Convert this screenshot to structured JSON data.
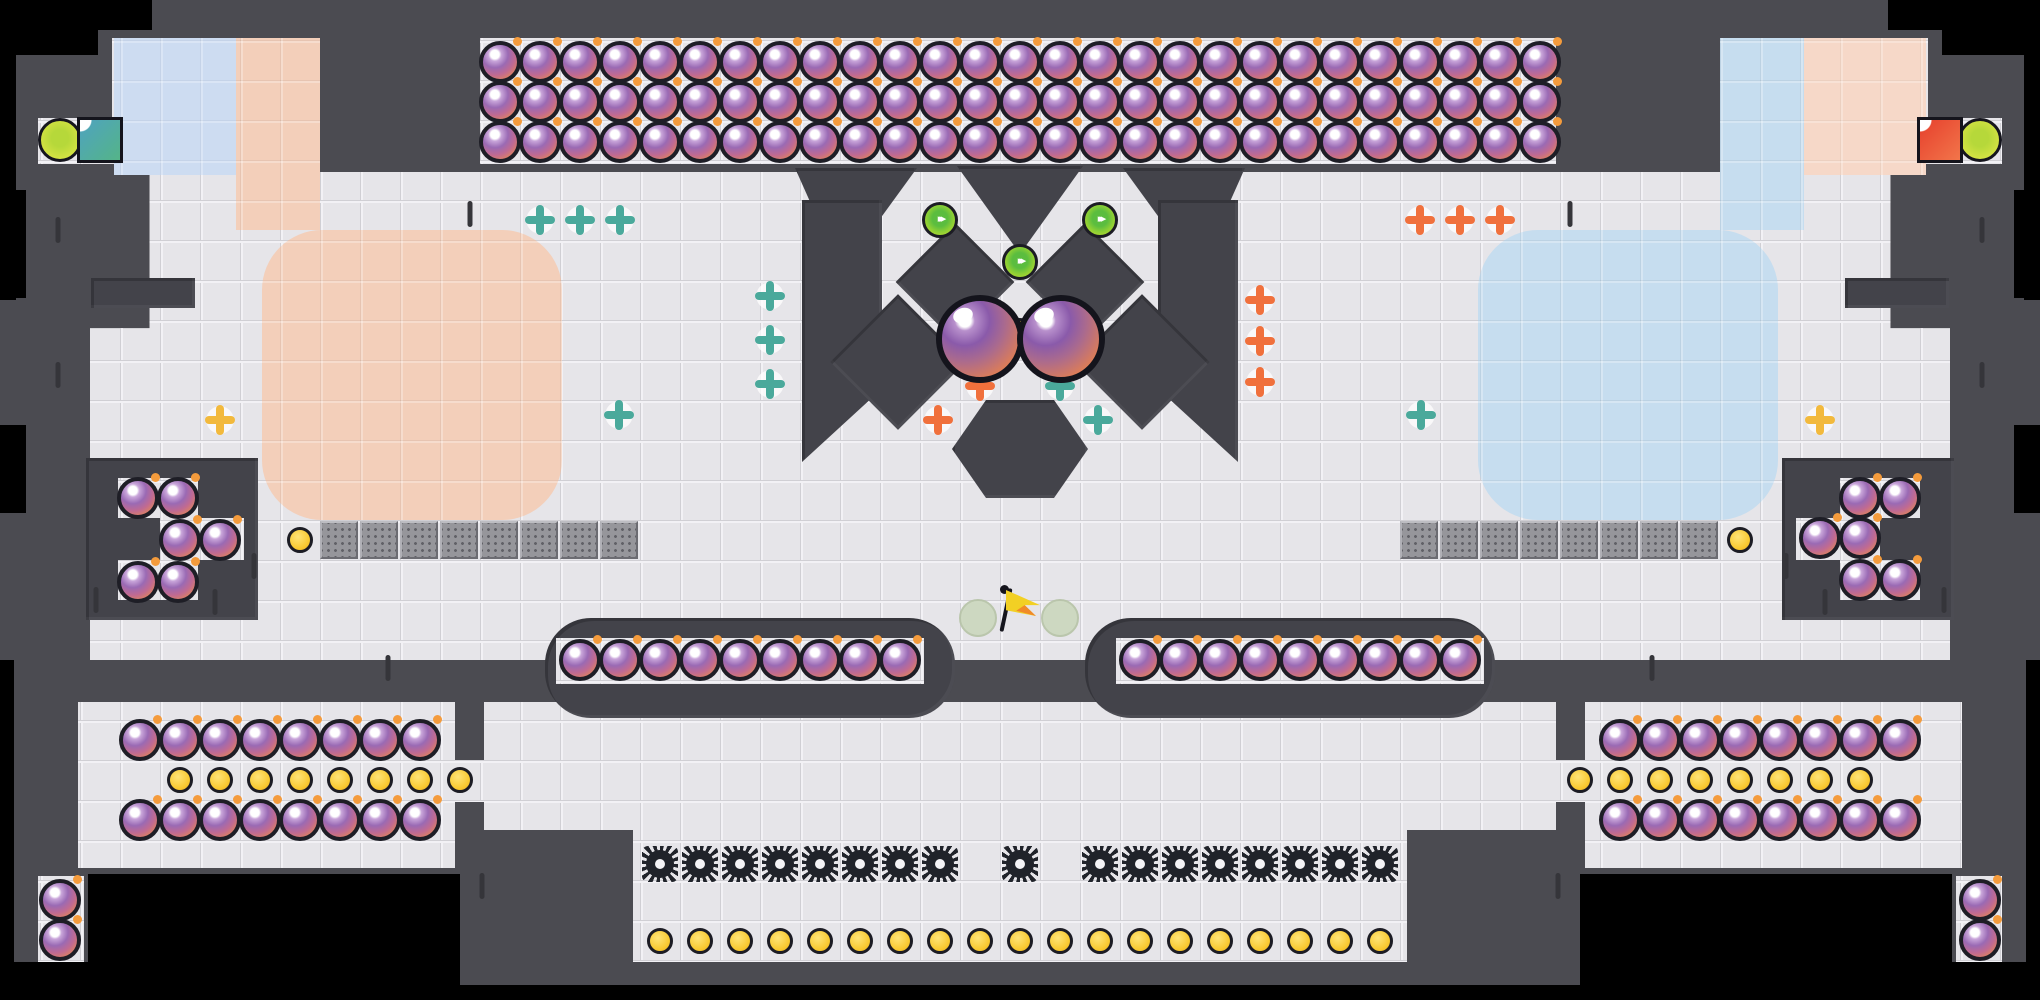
{
  "scene": {
    "name": "bomb-arena-level",
    "canvas": {
      "width": 2040,
      "height": 1000
    },
    "colors": {
      "background": "#000000",
      "wall": "#4b4b51",
      "obstacle": "#43434a",
      "floor": "#e6e5e9",
      "pastel_pink": "#f3cfba",
      "pastel_blue": "#c6ddef",
      "checker_blue": "#cddcf1",
      "checker_pink": "#f6d8c8",
      "bomb_purple": "#9a6ab4",
      "bomb_orange": "#ea9252",
      "coin_yellow": "#f9c930",
      "saw_black": "#20232a",
      "turret_teal": "#4aa99b",
      "turret_orange": "#f0703c",
      "turret_yellow": "#f2b93c",
      "green_orb": "#8ccf35",
      "player_orb": "#d2e242",
      "goal_teal": "#4fa3c0",
      "goal_red": "#e6402d",
      "flag_yellow": "#f2d024",
      "conveyor_gray": "#96969b"
    },
    "floors": [
      {
        "x": 480,
        "y": 38,
        "w": 1076,
        "h": 126
      },
      {
        "x": 38,
        "y": 118,
        "w": 84,
        "h": 46
      },
      {
        "x": 1918,
        "y": 118,
        "w": 84,
        "h": 46
      },
      {
        "x": 112,
        "y": 38,
        "w": 208,
        "h": 137,
        "clip": "polygon(0 0,100% 0,100% 100%,28% 100%,0 62%)"
      },
      {
        "x": 1720,
        "y": 38,
        "w": 208,
        "h": 137,
        "clip": "polygon(0 0,100% 0,100% 62%,72% 100%,0 100%)"
      },
      {
        "x": 90,
        "y": 172,
        "w": 1860,
        "h": 488,
        "clip": "polygon(3.2% 0,96.8% 0,96.8% 32%,100% 32%,100% 100%,0 100%,0 32%,3.2% 32%)"
      },
      {
        "x": 78,
        "y": 702,
        "w": 377,
        "h": 166
      },
      {
        "x": 1585,
        "y": 702,
        "w": 377,
        "h": 166
      },
      {
        "x": 440,
        "y": 760,
        "w": 104,
        "h": 42
      },
      {
        "x": 1500,
        "y": 760,
        "w": 104,
        "h": 42
      },
      {
        "x": 484,
        "y": 702,
        "w": 1072,
        "h": 128
      },
      {
        "x": 633,
        "y": 830,
        "w": 774,
        "h": 132
      },
      {
        "x": 38,
        "y": 876,
        "w": 46,
        "h": 88
      },
      {
        "x": 1956,
        "y": 876,
        "w": 46,
        "h": 88
      }
    ],
    "decor_patches": [
      {
        "kind": "checker",
        "color": "#cddcf1",
        "x": 114,
        "y": 38,
        "w": 124,
        "h": 137
      },
      {
        "kind": "checker",
        "color": "#f6d8c8",
        "x": 1802,
        "y": 38,
        "w": 124,
        "h": 137
      },
      {
        "kind": "patch",
        "color": "#f3cfba",
        "x": 236,
        "y": 38,
        "w": 84,
        "h": 192,
        "r": 0
      },
      {
        "kind": "patch",
        "color": "#c6ddef",
        "x": 1720,
        "y": 38,
        "w": 84,
        "h": 192,
        "r": 0
      },
      {
        "kind": "patch",
        "color": "#f3cfba",
        "x": 262,
        "y": 230,
        "w": 300,
        "h": 290,
        "r": 60
      },
      {
        "kind": "patch",
        "color": "#c6ddef",
        "x": 1478,
        "y": 230,
        "w": 300,
        "h": 290,
        "r": 60
      }
    ],
    "walls": [
      {
        "t": "rect",
        "x": 91,
        "y": 278,
        "w": 104,
        "h": 30
      },
      {
        "t": "rect",
        "x": 1845,
        "y": 278,
        "w": 104,
        "h": 30
      },
      {
        "t": "rect",
        "x": 86,
        "y": 458,
        "w": 172,
        "h": 162
      },
      {
        "t": "rect",
        "x": 1782,
        "y": 458,
        "w": 172,
        "h": 162
      },
      {
        "t": "rect",
        "x": 795,
        "y": 168,
        "w": 122,
        "h": 104,
        "clip": "polygon(0 0,100% 0,38% 100%)"
      },
      {
        "t": "rect",
        "x": 1123,
        "y": 168,
        "w": 122,
        "h": 104,
        "clip": "polygon(0 0,100% 0,62% 100%)"
      },
      {
        "t": "rect",
        "x": 957,
        "y": 166,
        "w": 126,
        "h": 88,
        "clip": "polygon(0 0,100% 0,50% 100%)"
      },
      {
        "t": "rect",
        "x": 802,
        "y": 200,
        "w": 80,
        "h": 262,
        "clip": "polygon(0 0,100% 0,100% 72%,0 100%)"
      },
      {
        "t": "rect",
        "x": 1158,
        "y": 200,
        "w": 80,
        "h": 262,
        "clip": "polygon(0 0,100% 0,100% 100%,0 72%)"
      },
      {
        "t": "dia",
        "x": 955,
        "y": 282,
        "s": 84
      },
      {
        "t": "dia",
        "x": 1085,
        "y": 282,
        "s": 84
      },
      {
        "t": "dia",
        "x": 898,
        "y": 362,
        "s": 96
      },
      {
        "t": "dia",
        "x": 1142,
        "y": 362,
        "s": 96
      },
      {
        "t": "hex",
        "x": 1020,
        "y": 449,
        "w": 136,
        "h": 98
      },
      {
        "t": "caps",
        "x": 545,
        "y": 618,
        "w": 410,
        "h": 100
      },
      {
        "t": "caps",
        "x": 1085,
        "y": 618,
        "w": 410,
        "h": 100
      }
    ],
    "inner_floors": [
      {
        "x": 556,
        "y": 638,
        "w": 368,
        "h": 46
      },
      {
        "x": 1116,
        "y": 638,
        "w": 368,
        "h": 46
      },
      {
        "x": 118,
        "y": 478,
        "w": 80,
        "h": 40
      },
      {
        "x": 160,
        "y": 518,
        "w": 84,
        "h": 42
      },
      {
        "x": 118,
        "y": 560,
        "w": 80,
        "h": 40
      },
      {
        "x": 1840,
        "y": 478,
        "w": 80,
        "h": 40
      },
      {
        "x": 1796,
        "y": 518,
        "w": 84,
        "h": 42
      },
      {
        "x": 1840,
        "y": 560,
        "w": 80,
        "h": 40
      }
    ],
    "black_cutouts": [
      {
        "x": 0,
        "y": 0,
        "w": 152,
        "h": 30
      },
      {
        "x": 0,
        "y": 0,
        "w": 98,
        "h": 55
      },
      {
        "x": 1888,
        "y": 0,
        "w": 152,
        "h": 30
      },
      {
        "x": 1942,
        "y": 0,
        "w": 98,
        "h": 55
      },
      {
        "x": 0,
        "y": 30,
        "w": 16,
        "h": 270
      },
      {
        "x": 2024,
        "y": 30,
        "w": 16,
        "h": 270
      },
      {
        "x": 0,
        "y": 190,
        "w": 26,
        "h": 108
      },
      {
        "x": 2014,
        "y": 190,
        "w": 26,
        "h": 108
      },
      {
        "x": 0,
        "y": 425,
        "w": 26,
        "h": 88
      },
      {
        "x": 2014,
        "y": 425,
        "w": 26,
        "h": 88
      },
      {
        "x": 0,
        "y": 660,
        "w": 14,
        "h": 340
      },
      {
        "x": 2026,
        "y": 660,
        "w": 14,
        "h": 340
      },
      {
        "x": 88,
        "y": 874,
        "w": 372,
        "h": 126
      },
      {
        "x": 1580,
        "y": 874,
        "w": 372,
        "h": 126
      },
      {
        "x": 0,
        "y": 962,
        "w": 92,
        "h": 38
      },
      {
        "x": 1948,
        "y": 962,
        "w": 92,
        "h": 38
      },
      {
        "x": 0,
        "y": 985,
        "w": 2040,
        "h": 15
      }
    ],
    "wall_dashes": [
      [
        58,
        230
      ],
      [
        58,
        375
      ],
      [
        96,
        600
      ],
      [
        215,
        602
      ],
      [
        254,
        566
      ],
      [
        470,
        214
      ],
      [
        1570,
        214
      ],
      [
        1982,
        230
      ],
      [
        1982,
        375
      ],
      [
        1944,
        600
      ],
      [
        1825,
        602
      ],
      [
        1786,
        566
      ],
      [
        482,
        886
      ],
      [
        1558,
        886
      ],
      [
        388,
        668
      ],
      [
        1652,
        668
      ]
    ],
    "entities": {
      "bomb_grids": [
        {
          "x0": 500,
          "y0": 62,
          "cols": 27,
          "rows": 3,
          "step": 40
        },
        {
          "x0": 580,
          "y0": 660,
          "cols": 9,
          "rows": 1,
          "step": 40
        },
        {
          "x0": 1140,
          "y0": 660,
          "cols": 9,
          "rows": 1,
          "step": 40
        },
        {
          "x0": 140,
          "y0": 740,
          "cols": 8,
          "rows": 1,
          "step": 40
        },
        {
          "x0": 140,
          "y0": 820,
          "cols": 8,
          "rows": 1,
          "step": 40
        },
        {
          "x0": 1620,
          "y0": 740,
          "cols": 8,
          "rows": 1,
          "step": 40
        },
        {
          "x0": 1620,
          "y0": 820,
          "cols": 8,
          "rows": 1,
          "step": 40
        }
      ],
      "bombs": [
        [
          138,
          498
        ],
        [
          178,
          498
        ],
        [
          180,
          540
        ],
        [
          220,
          540
        ],
        [
          138,
          582
        ],
        [
          178,
          582
        ],
        [
          1860,
          498
        ],
        [
          1900,
          498
        ],
        [
          1820,
          538
        ],
        [
          1860,
          538
        ],
        [
          1860,
          580
        ],
        [
          1900,
          580
        ],
        [
          60,
          900
        ],
        [
          60,
          940
        ],
        [
          1980,
          900
        ],
        [
          1980,
          940
        ]
      ],
      "coin_rows": [
        {
          "x0": 180,
          "y": 780,
          "count": 8,
          "step": 40
        },
        {
          "x0": 1580,
          "y": 780,
          "count": 8,
          "step": 40
        },
        {
          "x0": 660,
          "y": 941,
          "count": 19,
          "step": 40
        }
      ],
      "coins": [
        [
          300,
          540
        ],
        [
          1740,
          540
        ],
        [
          1020,
          331
        ]
      ],
      "saw_rows": [
        {
          "x0": 660,
          "y": 864,
          "count": 8,
          "step": 40
        },
        {
          "x0": 1100,
          "y": 864,
          "count": 8,
          "step": 40
        }
      ],
      "saws": [
        [
          1020,
          864
        ]
      ],
      "turrets": [
        {
          "x": 540,
          "y": 220,
          "c": "teal"
        },
        {
          "x": 580,
          "y": 220,
          "c": "teal"
        },
        {
          "x": 620,
          "y": 220,
          "c": "teal"
        },
        {
          "x": 770,
          "y": 296,
          "c": "teal"
        },
        {
          "x": 770,
          "y": 340,
          "c": "teal"
        },
        {
          "x": 770,
          "y": 384,
          "c": "teal"
        },
        {
          "x": 619,
          "y": 415,
          "c": "teal"
        },
        {
          "x": 1421,
          "y": 415,
          "c": "teal"
        },
        {
          "x": 1420,
          "y": 220,
          "c": "orange"
        },
        {
          "x": 1460,
          "y": 220,
          "c": "orange"
        },
        {
          "x": 1500,
          "y": 220,
          "c": "orange"
        },
        {
          "x": 1260,
          "y": 300,
          "c": "orange"
        },
        {
          "x": 1260,
          "y": 341,
          "c": "orange"
        },
        {
          "x": 1260,
          "y": 382,
          "c": "orange"
        },
        {
          "x": 980,
          "y": 386,
          "c": "orange"
        },
        {
          "x": 1060,
          "y": 386,
          "c": "teal"
        },
        {
          "x": 938,
          "y": 420,
          "c": "orange"
        },
        {
          "x": 1098,
          "y": 420,
          "c": "teal"
        },
        {
          "x": 220,
          "y": 420,
          "c": "yellow"
        },
        {
          "x": 1820,
          "y": 420,
          "c": "yellow"
        }
      ],
      "turret_colors": {
        "teal": "#4aa99b",
        "orange": "#f0703c",
        "yellow": "#f2b93c"
      },
      "green_orbs": [
        [
          940,
          220
        ],
        [
          1100,
          220
        ],
        [
          1020,
          262
        ]
      ],
      "green_orb_marks": "▸▸▸",
      "big_orbs": [
        [
          980,
          339
        ],
        [
          1061,
          339
        ]
      ],
      "player_orbs": [
        [
          60,
          140
        ],
        [
          1980,
          140
        ]
      ],
      "goal_squares": [
        {
          "x": 100,
          "y": 140,
          "c": "teal"
        },
        {
          "x": 1940,
          "y": 140,
          "c": "red"
        }
      ],
      "flag": {
        "x": 1020,
        "y": 610
      },
      "ghost_orbs": [
        [
          978,
          618
        ],
        [
          1060,
          618
        ]
      ],
      "conveyors": [
        {
          "x0": 320,
          "y": 521,
          "count": 8,
          "step": 40
        },
        {
          "x0": 1400,
          "y": 521,
          "count": 8,
          "step": 40
        }
      ]
    }
  }
}
